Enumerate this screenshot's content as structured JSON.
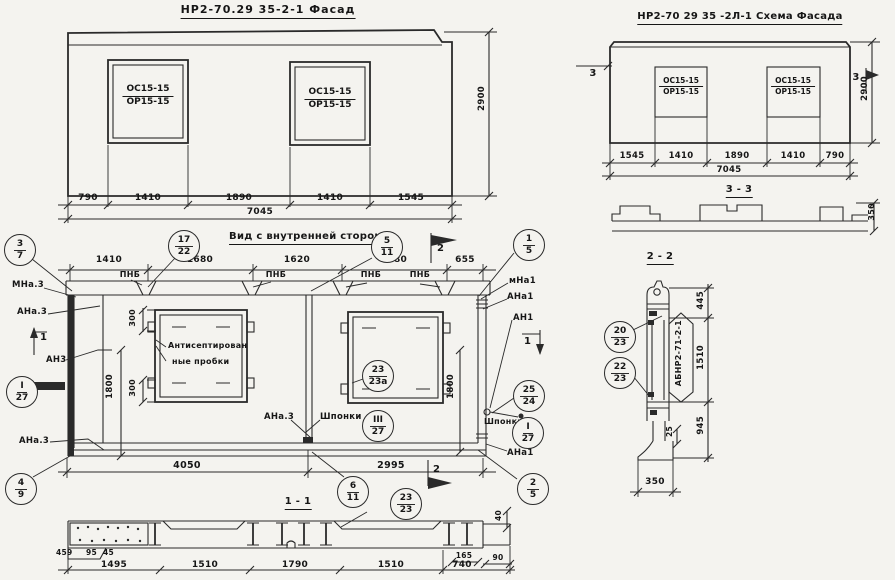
{
  "facade": {
    "title": "НР2-70.29 35-2-1 Фасад",
    "win1_top": "ОС15-15",
    "win1_bot": "ОР15-15",
    "win2_top": "ОС15-15",
    "win2_bot": "ОР15-15",
    "dims": [
      "790",
      "1410",
      "1890",
      "1410",
      "1545"
    ],
    "total": "7045",
    "height": "2900"
  },
  "schema": {
    "title": "НР2-70 29 35 -2Л-1 Схема Фасада",
    "win1_top": "ОС15-15",
    "win1_bot": "ОР15-15",
    "win2_top": "ОС15-15",
    "win2_bot": "ОР15-15",
    "dims": [
      "1545",
      "1410",
      "1890",
      "1410",
      "790"
    ],
    "total": "7045",
    "height": "2900",
    "marker_left": "3",
    "marker_right": "3",
    "section33": {
      "label": "3 - 3",
      "height": "350"
    }
  },
  "inner": {
    "title": "Вид с внутренней стороны",
    "dims_top": [
      "1410",
      "1680",
      "1620",
      "1680",
      "655"
    ],
    "pnb": [
      "ПНБ",
      "ПНБ",
      "ПНБ",
      "ПНБ"
    ],
    "callouts": {
      "c37": {
        "t": "3",
        "b": "7"
      },
      "c1722": {
        "t": "17",
        "b": "22"
      },
      "c511": {
        "t": "5",
        "b": "11"
      },
      "c15": {
        "t": "1",
        "b": "5"
      },
      "cI27": {
        "t": "I",
        "b": "27"
      },
      "c49": {
        "t": "4",
        "b": "9"
      },
      "c23a": {
        "t": "23",
        "b": "23а"
      },
      "cIII27": {
        "t": "III",
        "b": "27"
      },
      "cI27r": {
        "t": "I",
        "b": "27"
      },
      "c2524": {
        "t": "25",
        "b": "24"
      },
      "c611": {
        "t": "6",
        "b": "11"
      },
      "c25": {
        "t": "2",
        "b": "5"
      }
    },
    "markers": {
      "m2top": "2",
      "m2bot": "2",
      "m1left": "1",
      "m1right": "1"
    },
    "labels": {
      "mna3": "МНа.3",
      "ana3": "АНа.3",
      "an3": "АН3",
      "ana3_low": "АНа.3",
      "ana3_mid": "АНа.3",
      "mna1": "мНа1",
      "ana1": "АНа1",
      "an1": "АН1",
      "ana1_low": "АНа1",
      "shponki_left": "Шпонки",
      "shponki_right": "Шпонки"
    },
    "note1": "Антисептирован",
    "note2": "ные пробки",
    "d300a": "300",
    "d300b": "300",
    "d1800l": "1800",
    "d1800r": "1800",
    "d4050": "4050",
    "d2995": "2995",
    "section_label": "1 - 1"
  },
  "s11": {
    "c2323": {
      "t": "23",
      "b": "23"
    },
    "dims": [
      "1495",
      "1510",
      "1790",
      "1510",
      "740"
    ],
    "small": [
      "459",
      "95",
      "45"
    ],
    "d165": "165",
    "d90": "90",
    "d40": "40"
  },
  "s22": {
    "label": "2 - 2",
    "c2023": {
      "t": "20",
      "b": "23"
    },
    "c2223": {
      "t": "22",
      "b": "23"
    },
    "stamp": "АБНР2-71-2-1",
    "d445": "445",
    "d1510": "1510",
    "d945": "945",
    "d25": "25",
    "d350": "350"
  }
}
